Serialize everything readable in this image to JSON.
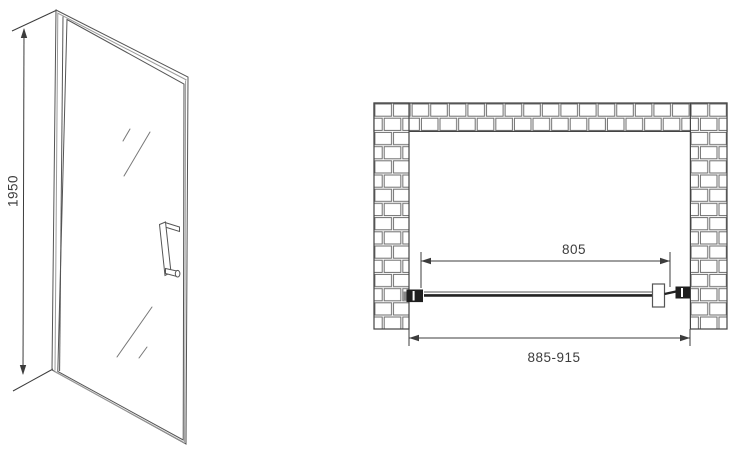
{
  "drawing": {
    "type": "shower-door-technical-drawing",
    "front_view": {
      "height_dimension_label": "1950"
    },
    "plan_view": {
      "glass_width_label": "805",
      "installation_width_label": "885-915"
    },
    "colors": {
      "background": "#ffffff",
      "line": "#555555",
      "line_light": "#9a9a9a",
      "dimension": "#3c3c3c",
      "dark_fill": "#1f1f1f",
      "brick_outline": "#6e6e6e"
    }
  }
}
